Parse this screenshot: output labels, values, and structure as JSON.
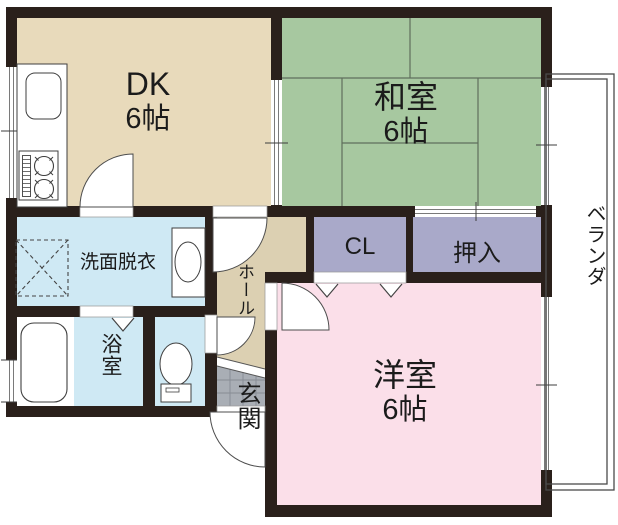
{
  "rooms": {
    "dk": {
      "name": "DK",
      "size": "6帖"
    },
    "washitsu": {
      "name": "和室",
      "size": "6帖"
    },
    "yoshitsu": {
      "name": "洋室",
      "size": "6帖"
    },
    "senmen": {
      "name": "洗面脱衣"
    },
    "bath": {
      "name": "浴室"
    },
    "hall": {
      "name": "ホール"
    },
    "genkan": {
      "name": "玄関"
    },
    "cl": {
      "name": "CL"
    },
    "oshiire": {
      "name": "押入"
    },
    "veranda": {
      "name": "ベランダ"
    }
  },
  "colors": {
    "wall": "#2a201b",
    "dk": "#e8dabb",
    "washitsu": "#a7c8a0",
    "yoshitsu": "#fbdfe9",
    "water": "#cfe9f4",
    "hall": "#dcd0b2",
    "closet": "#a9a9c9",
    "tile": "#a9aeb5"
  }
}
